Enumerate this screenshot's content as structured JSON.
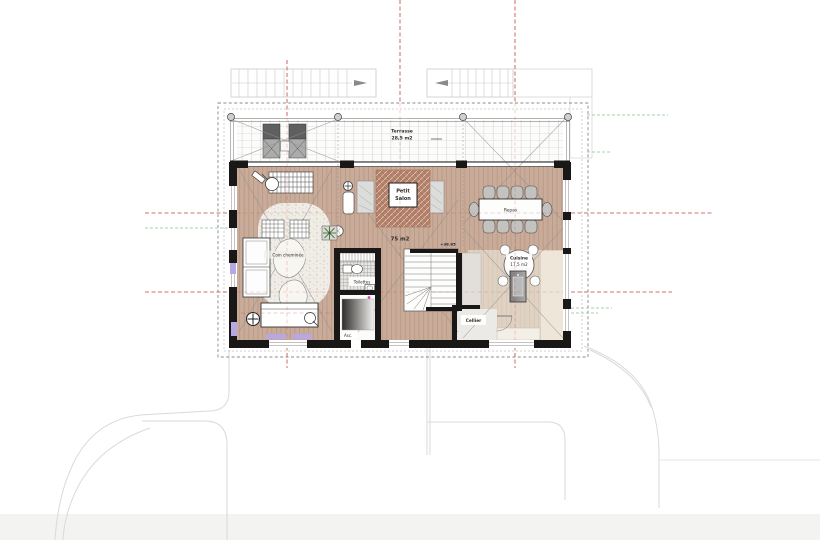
{
  "plan": {
    "terrace": {
      "name": "Terrasse",
      "area": "28,5 m2"
    },
    "living": {
      "area": "75 m2"
    },
    "petit_salon": {
      "line1": "Petit",
      "line2": "Salon"
    },
    "dining": {
      "name": "Repas"
    },
    "kitchen": {
      "name": "Cuisine",
      "area": "17,5 m2"
    },
    "fireplace_corner": {
      "name": "Coin cheminée"
    },
    "toilets": {
      "name": "Toilettes"
    },
    "elevator": {
      "name": "Asc."
    },
    "pantry": {
      "name": "Cellier"
    },
    "level_marker": "+38.85"
  },
  "colors": {
    "axis_red": "#c0453a",
    "axis_green": "#a8cfa8",
    "wall_black": "#1a1816",
    "floor_wood": "#c9ab99",
    "rug_terracotta": "#b5826b",
    "accent_lilac": "#b7a8e3",
    "accent_magenta": "#e03ccc",
    "site_line_gray": "#dadada"
  }
}
